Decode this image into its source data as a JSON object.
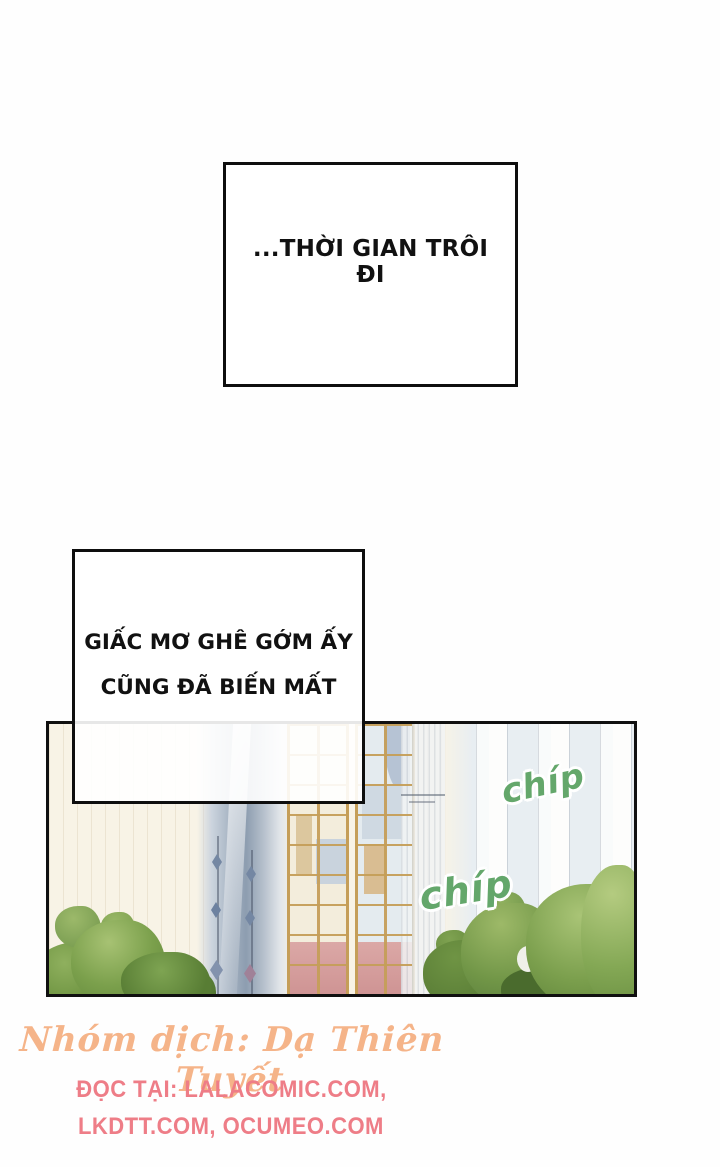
{
  "captions": {
    "box1": {
      "text": "...THỜI GIAN TRÔI ĐI"
    },
    "box2": {
      "line1": "GIẤC MƠ GHÊ GỚM ẤY",
      "line2": "CŨNG ĐÃ BIẾN MẤT"
    }
  },
  "panel": {
    "sfx": [
      {
        "text": "chíp"
      },
      {
        "text": "chíp"
      }
    ],
    "sfx_color": "#64a76b"
  },
  "footer": {
    "credit_line": "Nhóm dịch: Dạ Thiên Tuyết",
    "credit_color": "#f5b489",
    "read_at_line1": "ĐỌC TẠI: LALACOMIC.COM,",
    "read_at_line2": "LKDTT.COM, OCUMEO.COM",
    "read_at_color": "#ee7d87"
  }
}
